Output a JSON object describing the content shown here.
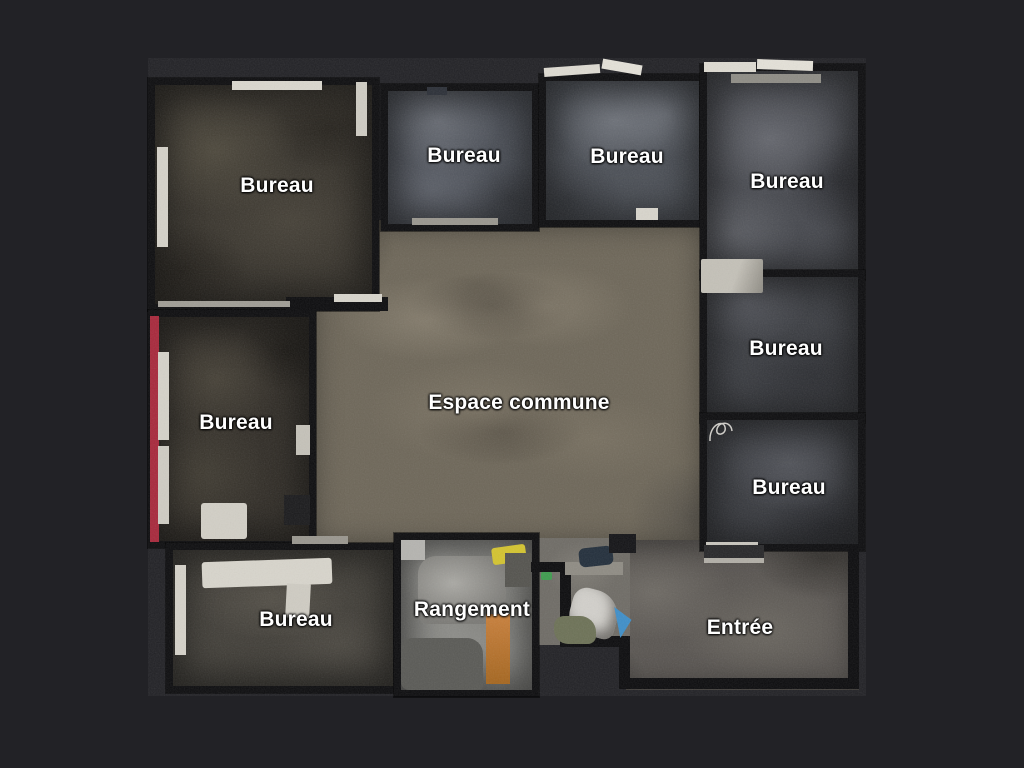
{
  "scene": {
    "view": "floorplan-top-down",
    "background_color": "#222226",
    "wall_color": "#0d0d0f",
    "label_color": "#ffffff",
    "red_wall_color": "#a8293c"
  },
  "rooms": [
    {
      "id": "bureau-top-left",
      "label": "Bureau"
    },
    {
      "id": "bureau-top-mid-left",
      "label": "Bureau"
    },
    {
      "id": "bureau-top-mid-right",
      "label": "Bureau"
    },
    {
      "id": "bureau-top-right",
      "label": "Bureau"
    },
    {
      "id": "bureau-right-middle",
      "label": "Bureau"
    },
    {
      "id": "bureau-right-lower",
      "label": "Bureau"
    },
    {
      "id": "bureau-left-middle",
      "label": "Bureau"
    },
    {
      "id": "espace-commune",
      "label": "Espace commune"
    },
    {
      "id": "bureau-bottom-left",
      "label": "Bureau"
    },
    {
      "id": "rangement",
      "label": "Rangement"
    },
    {
      "id": "entree",
      "label": "Entrée"
    }
  ]
}
